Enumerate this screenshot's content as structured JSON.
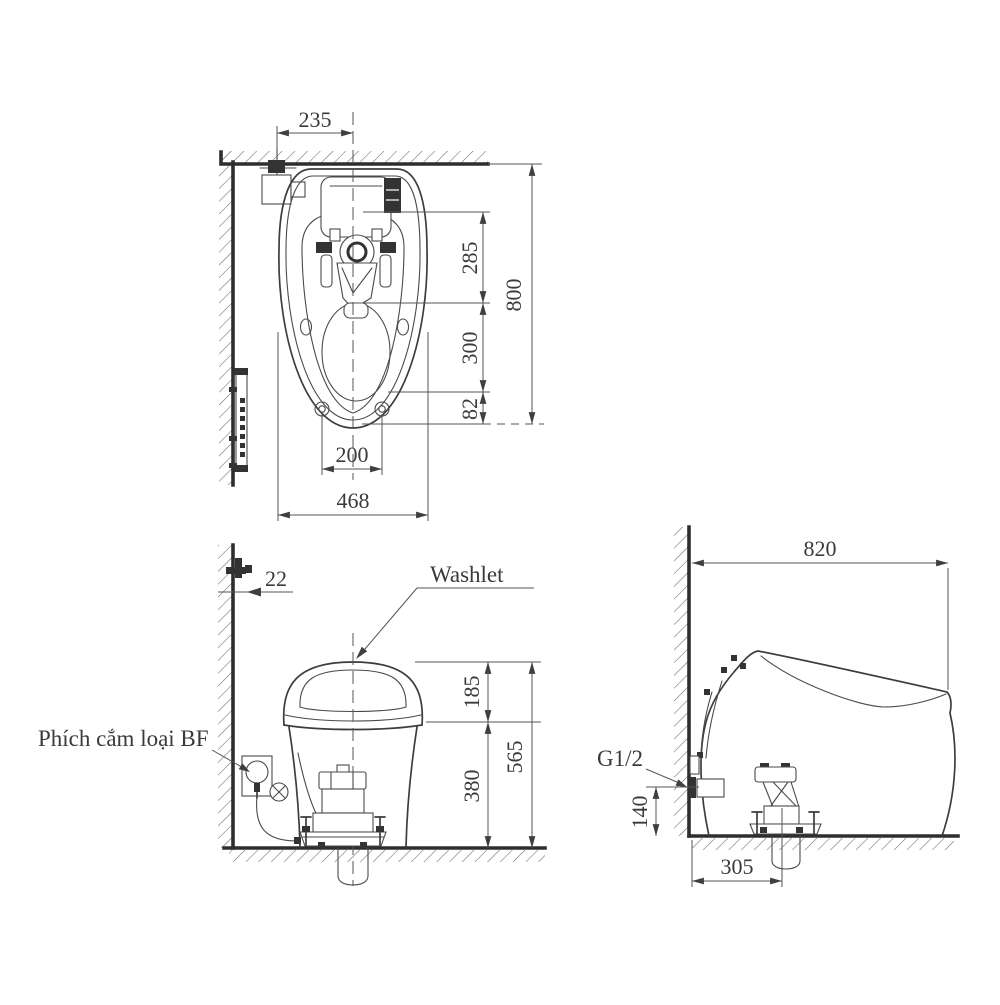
{
  "colors": {
    "background": "#ffffff",
    "line": "#3d3d3d",
    "dimension_line": "#555555",
    "text": "#3a3a3a"
  },
  "views": {
    "top": {
      "dims": {
        "supply_offset": "235",
        "tank_depth": "285",
        "overall_depth": "800",
        "bowl_depth": "300",
        "front_offset": "82",
        "bolt_spacing": "200",
        "overall_width": "468"
      }
    },
    "front": {
      "labels": {
        "washlet": "Washlet",
        "plug": "Phích cắm loại BF"
      },
      "dims": {
        "wall_gap": "22",
        "lid_height": "185",
        "rim_height": "380",
        "overall_height": "565"
      }
    },
    "side": {
      "labels": {
        "water_inlet": "G1/2"
      },
      "dims": {
        "overall_depth": "820",
        "inlet_height": "140",
        "drain_offset": "305"
      }
    }
  }
}
